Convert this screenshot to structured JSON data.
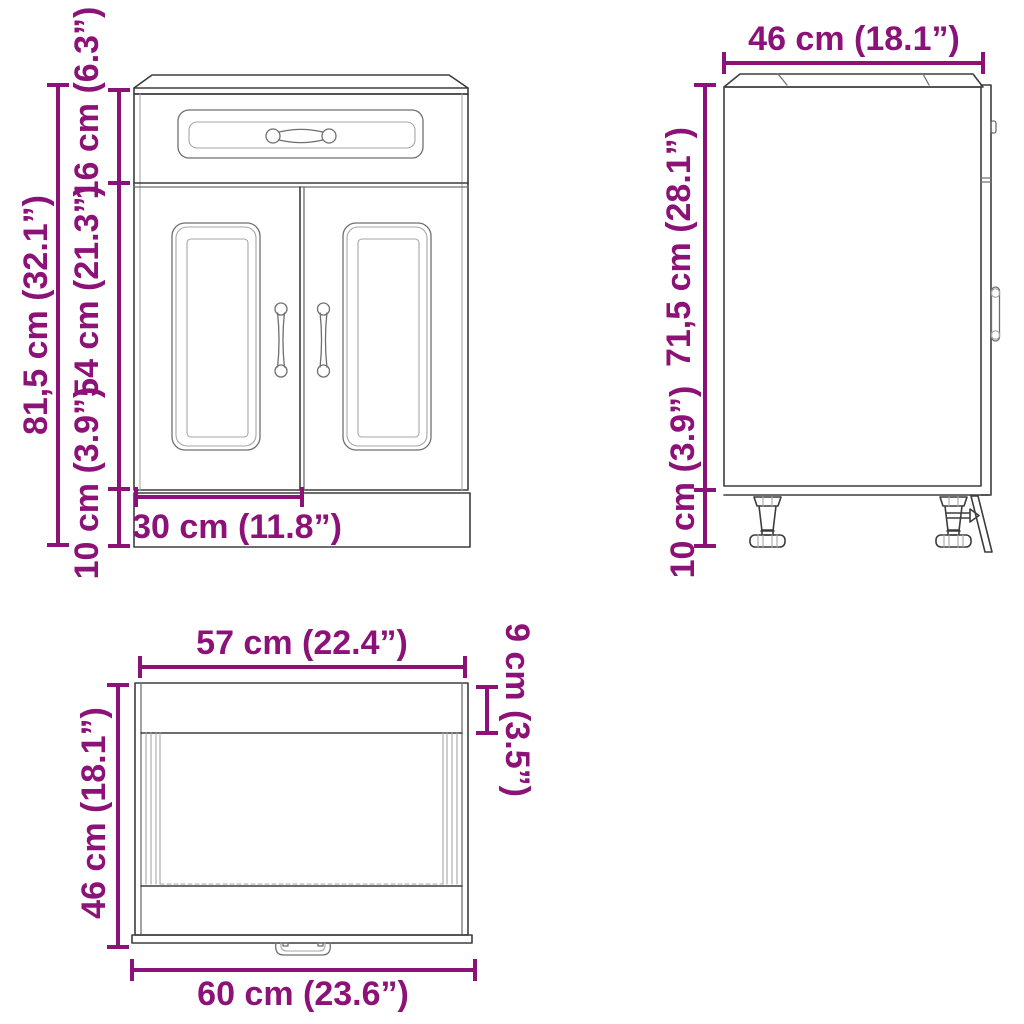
{
  "diagram_title": "Kitchen base cabinet dimension diagram",
  "views": {
    "front": {
      "name": "front-view",
      "dim_total_height": "81,5 cm (32.1”)",
      "dim_drawer_height": "16 cm (6.3”)",
      "dim_door_height": "54 cm (21.3”)",
      "dim_leg_height": "10 cm (3.9”)",
      "dim_door_width": "30 cm (11.8”)"
    },
    "side": {
      "name": "side-view",
      "dim_depth": "46 cm (18.1”)",
      "dim_body_height": "71,5 cm (28.1”)",
      "dim_leg_height": "10 cm (3.9”)"
    },
    "top": {
      "name": "top-view",
      "dim_inner_width": "57 cm (22.4”)",
      "dim_top_depth": "9 cm (3.5”)",
      "dim_depth": "46 cm (18.1”)",
      "dim_outer_width": "60 cm (23.6”)"
    }
  },
  "colors": {
    "dimension": "#8c1277",
    "line": "#3d3d3d",
    "background": "#ffffff"
  }
}
